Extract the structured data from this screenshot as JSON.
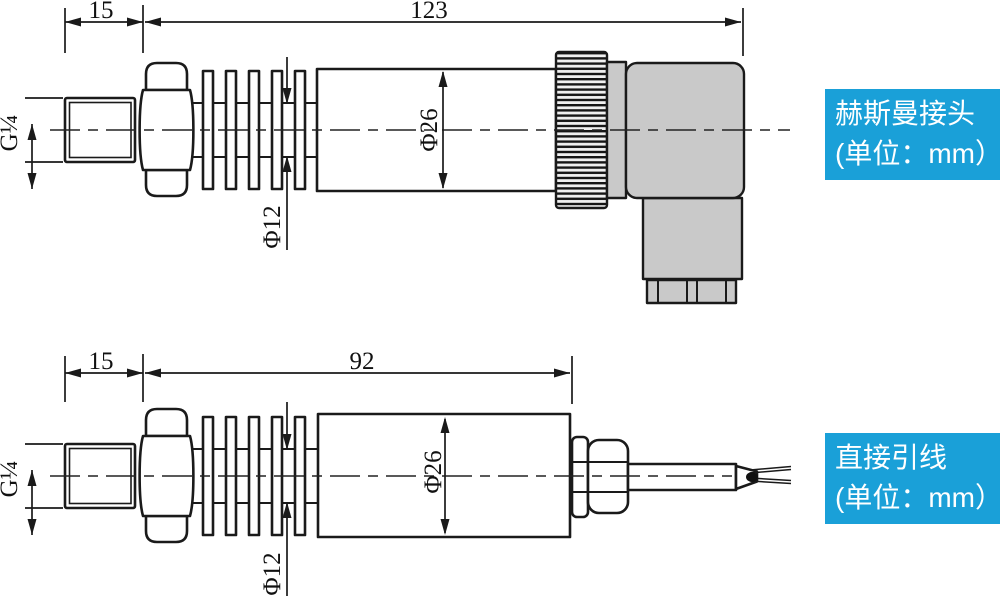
{
  "colors": {
    "label_background": "#1aa0d8",
    "label_text": "#ffffff",
    "housing_fill": "#c9c9c9",
    "line_color": "#1a1a1a"
  },
  "drawings": {
    "hirschmann": {
      "thread_spec": "G¼",
      "thread_length": "15",
      "total_length": "123",
      "body_diameter": "Φ26",
      "fin_diameter": "Φ12",
      "label_line1": "赫斯曼接头",
      "label_line2": "(单位：mm）"
    },
    "direct_lead": {
      "thread_spec": "G¼",
      "thread_length": "15",
      "total_length": "92",
      "body_diameter": "Φ26",
      "fin_diameter": "Φ12",
      "label_line1": "直接引线",
      "label_line2": "(单位：mm）"
    }
  }
}
